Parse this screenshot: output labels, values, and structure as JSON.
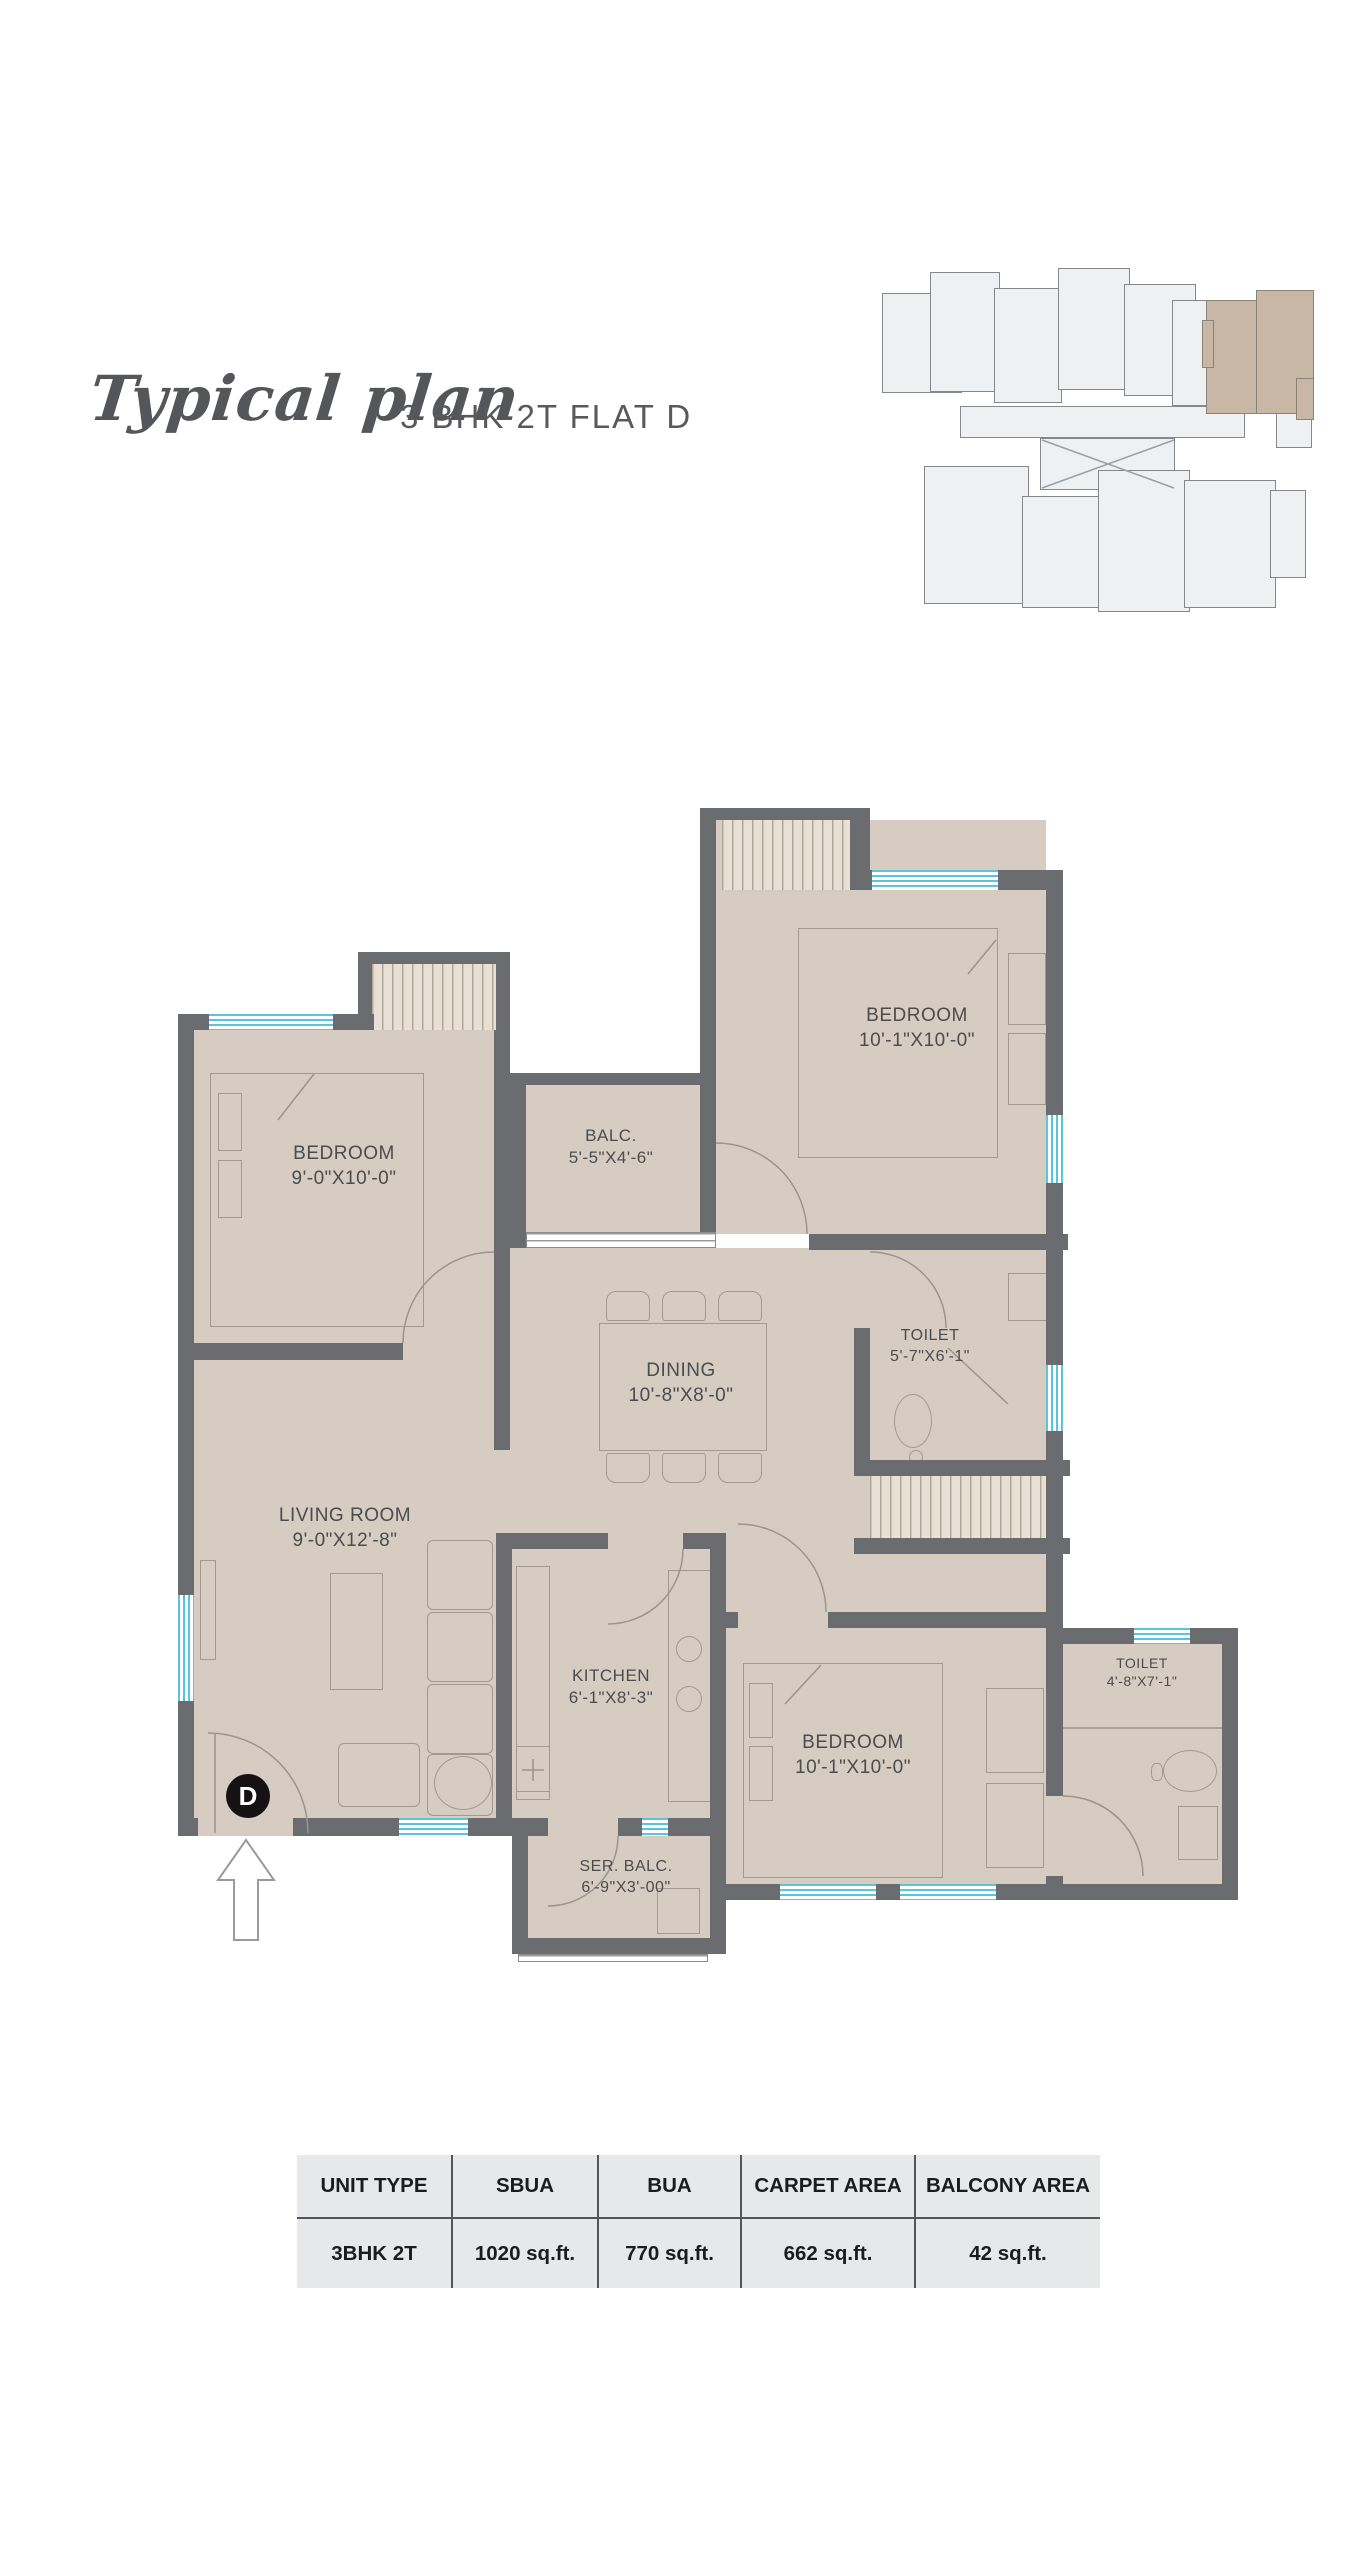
{
  "title": {
    "script": "Typical plan",
    "subtitle": "3 BHK 2T FLAT D"
  },
  "unit_marker": "D",
  "rooms": [
    {
      "id": "bedroom-left",
      "name": "BEDROOM",
      "dims": "9'-0\"X10'-0\""
    },
    {
      "id": "balcony",
      "name": "BALC.",
      "dims": "5'-5\"X4'-6\""
    },
    {
      "id": "bedroom-top",
      "name": "BEDROOM",
      "dims": "10'-1\"X10'-0\""
    },
    {
      "id": "toilet-1",
      "name": "TOILET",
      "dims": "5'-7\"X6'-1\""
    },
    {
      "id": "dining",
      "name": "DINING",
      "dims": "10'-8\"X8'-0\""
    },
    {
      "id": "living-room",
      "name": "LIVING ROOM",
      "dims": "9'-0\"X12'-8\""
    },
    {
      "id": "kitchen",
      "name": "KITCHEN",
      "dims": "6'-1\"X8'-3\""
    },
    {
      "id": "bedroom-bottom",
      "name": "BEDROOM",
      "dims": "10'-1\"X10'-0\""
    },
    {
      "id": "toilet-2",
      "name": "TOILET",
      "dims": "4'-8\"X7'-1\""
    },
    {
      "id": "service-balcony",
      "name": "SER. BALC.",
      "dims": "6'-9\"X3'-00\""
    }
  ],
  "table": {
    "headers": [
      "UNIT TYPE",
      "SBUA",
      "BUA",
      "CARPET AREA",
      "BALCONY AREA"
    ],
    "row": [
      "3BHK 2T",
      "1020 sq.ft.",
      "770 sq.ft.",
      "662 sq.ft.",
      "42 sq.ft."
    ]
  },
  "colors": {
    "wall": "#6b6c6f",
    "floor": "#d7ccc1",
    "window": "#5ac4dd",
    "hatch_bg": "#e8e0d4",
    "keyplan_unit": "#eef0f2",
    "keyplan_highlight": "#c8b7a5",
    "table_bg": "#e7e8ea",
    "text": "#4b4c4e"
  }
}
